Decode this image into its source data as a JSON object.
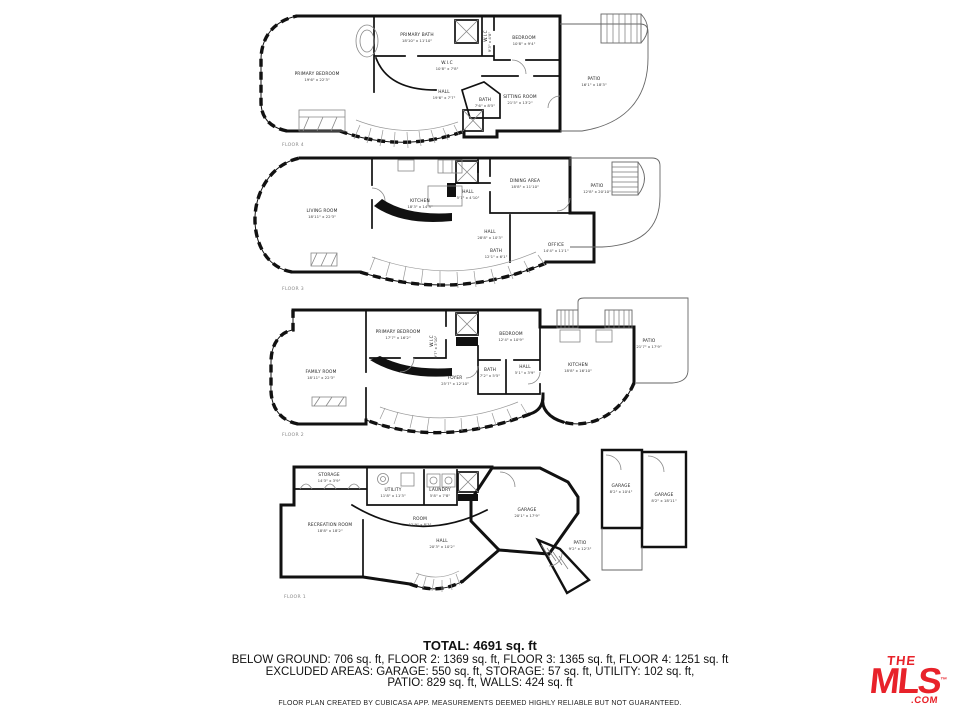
{
  "summary": {
    "total": "TOTAL: 4691 sq. ft",
    "line1": "BELOW GROUND: 706 sq. ft, FLOOR 2: 1369 sq. ft, FLOOR 3: 1365 sq. ft, FLOOR 4: 1251 sq. ft",
    "line2": "EXCLUDED AREAS: GARAGE: 550 sq. ft, STORAGE: 57 sq. ft, UTILITY: 102 sq. ft,",
    "line3": "PATIO: 829 sq. ft, WALLS: 424 sq. ft",
    "disclaimer": "FLOOR PLAN CREATED BY CUBICASA APP. MEASUREMENTS DEEMED HIGHLY RELIABLE BUT NOT GUARANTEED."
  },
  "branding": {
    "logo_the": "THE",
    "logo_mls": "MLS",
    "logo_tm": "™",
    "logo_com": ".COM",
    "logo_color": "#e8222a"
  },
  "floors": [
    {
      "label": "FLOOR 4",
      "rooms": [
        {
          "name": "PRIMARY BATH",
          "dims": "18'10\" x 11'10\""
        },
        {
          "name": "PRIMARY BEDROOM",
          "dims": "19'6\" x 22'3\""
        },
        {
          "name": "W.I.C",
          "dims": "10'8\" x 7'8\""
        },
        {
          "name": "HALL",
          "dims": "19'6\" x 7'7\""
        },
        {
          "name": "BATH",
          "dims": "7'6\" x 8'5\""
        },
        {
          "name": "W.I.C",
          "dims": "9'3\" x 4'8\""
        },
        {
          "name": "BEDROOM",
          "dims": "10'8\" x 9'4\""
        },
        {
          "name": "SITTING ROOM",
          "dims": "21'5\" x 13'2\""
        },
        {
          "name": "PATIO",
          "dims": "16'1\" x 18'3\""
        }
      ]
    },
    {
      "label": "FLOOR 3",
      "rooms": [
        {
          "name": "LIVING ROOM",
          "dims": "18'11\" x 22'3\""
        },
        {
          "name": "KITCHEN",
          "dims": "18'3\" x 14'3\""
        },
        {
          "name": "HALL",
          "dims": "5'7\" x 4'10\""
        },
        {
          "name": "HALL",
          "dims": "28'8\" x 10'3\""
        },
        {
          "name": "DINING AREA",
          "dims": "18'8\" x 11'10\""
        },
        {
          "name": "PATIO",
          "dims": "12'8\" x 20'10\""
        },
        {
          "name": "OFFICE",
          "dims": "14'4\" x 11'1\""
        },
        {
          "name": "BATH",
          "dims": "12'1\" x 6'1\""
        }
      ]
    },
    {
      "label": "FLOOR 2",
      "rooms": [
        {
          "name": "FAMILY ROOM",
          "dims": "18'11\" x 22'3\""
        },
        {
          "name": "PRIMARY BEDROOM",
          "dims": "17'7\" x 16'2\""
        },
        {
          "name": "W.I.C",
          "dims": "9'7\" x 3'10\""
        },
        {
          "name": "FOYER",
          "dims": "25'7\" x 12'10\""
        },
        {
          "name": "BEDROOM",
          "dims": "12'4\" x 10'9\""
        },
        {
          "name": "BATH",
          "dims": "7'2\" x 5'5\""
        },
        {
          "name": "HALL",
          "dims": "5'1\" x 3'9\""
        },
        {
          "name": "KITCHEN",
          "dims": "18'8\" x 16'10\""
        },
        {
          "name": "PATIO",
          "dims": "21'7\" x 17'9\""
        }
      ]
    },
    {
      "label": "FLOOR 1",
      "rooms": [
        {
          "name": "STORAGE",
          "dims": "14'3\" x 3'9\""
        },
        {
          "name": "UTILITY",
          "dims": "11'8\" x 11'3\""
        },
        {
          "name": "LAUNDRY",
          "dims": "5'8\" x 7'8\""
        },
        {
          "name": "RECREATION ROOM",
          "dims": "18'8\" x 18'2\""
        },
        {
          "name": "ROOM",
          "dims": "12'9\" x 8'3\""
        },
        {
          "name": "HALL",
          "dims": "20'3\" x 10'2\""
        },
        {
          "name": "GARAGE",
          "dims": "20'1\" x 17'9\""
        },
        {
          "name": "PATIO",
          "dims": "9'2\" x 12'3\""
        },
        {
          "name": "GARAGE",
          "dims": "8'2\" x 10'4\""
        },
        {
          "name": "GARAGE",
          "dims": "8'2\" x 18'11\""
        }
      ]
    }
  ]
}
